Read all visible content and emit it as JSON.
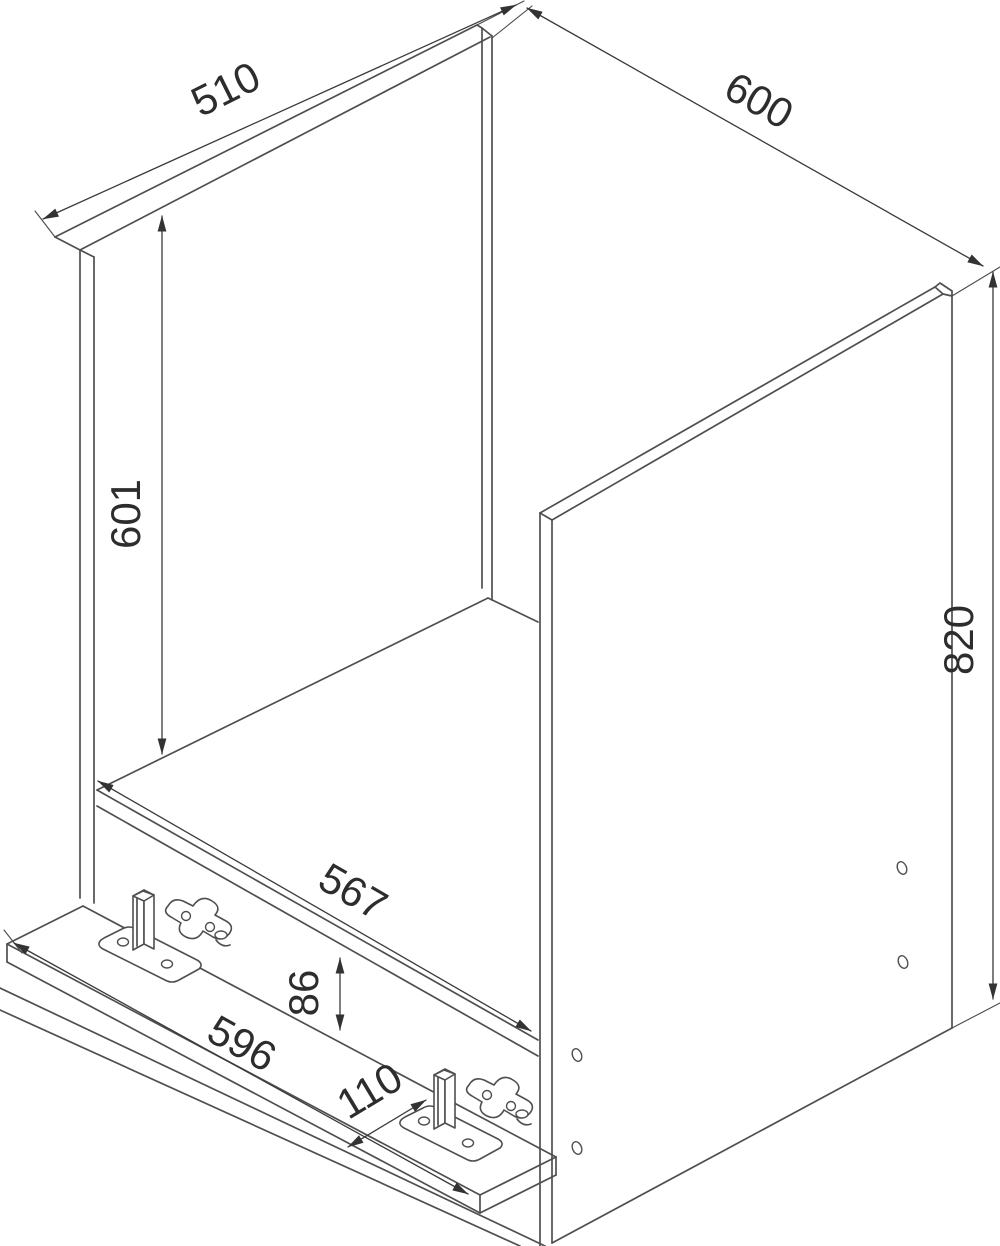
{
  "colors": {
    "background": "#ffffff",
    "part_line": "#4f4f4f",
    "dimension_line": "#3a3a3a",
    "label_text": "#2d2d2d"
  },
  "dimensions": {
    "top_left_depth": "510",
    "top_right_width": "600",
    "left_inner_height": "601",
    "right_total_height": "820",
    "middle_inner_width": "567",
    "front_step_height": "86",
    "bottom_rail_width": "596",
    "bottom_rail_depth": "110"
  }
}
